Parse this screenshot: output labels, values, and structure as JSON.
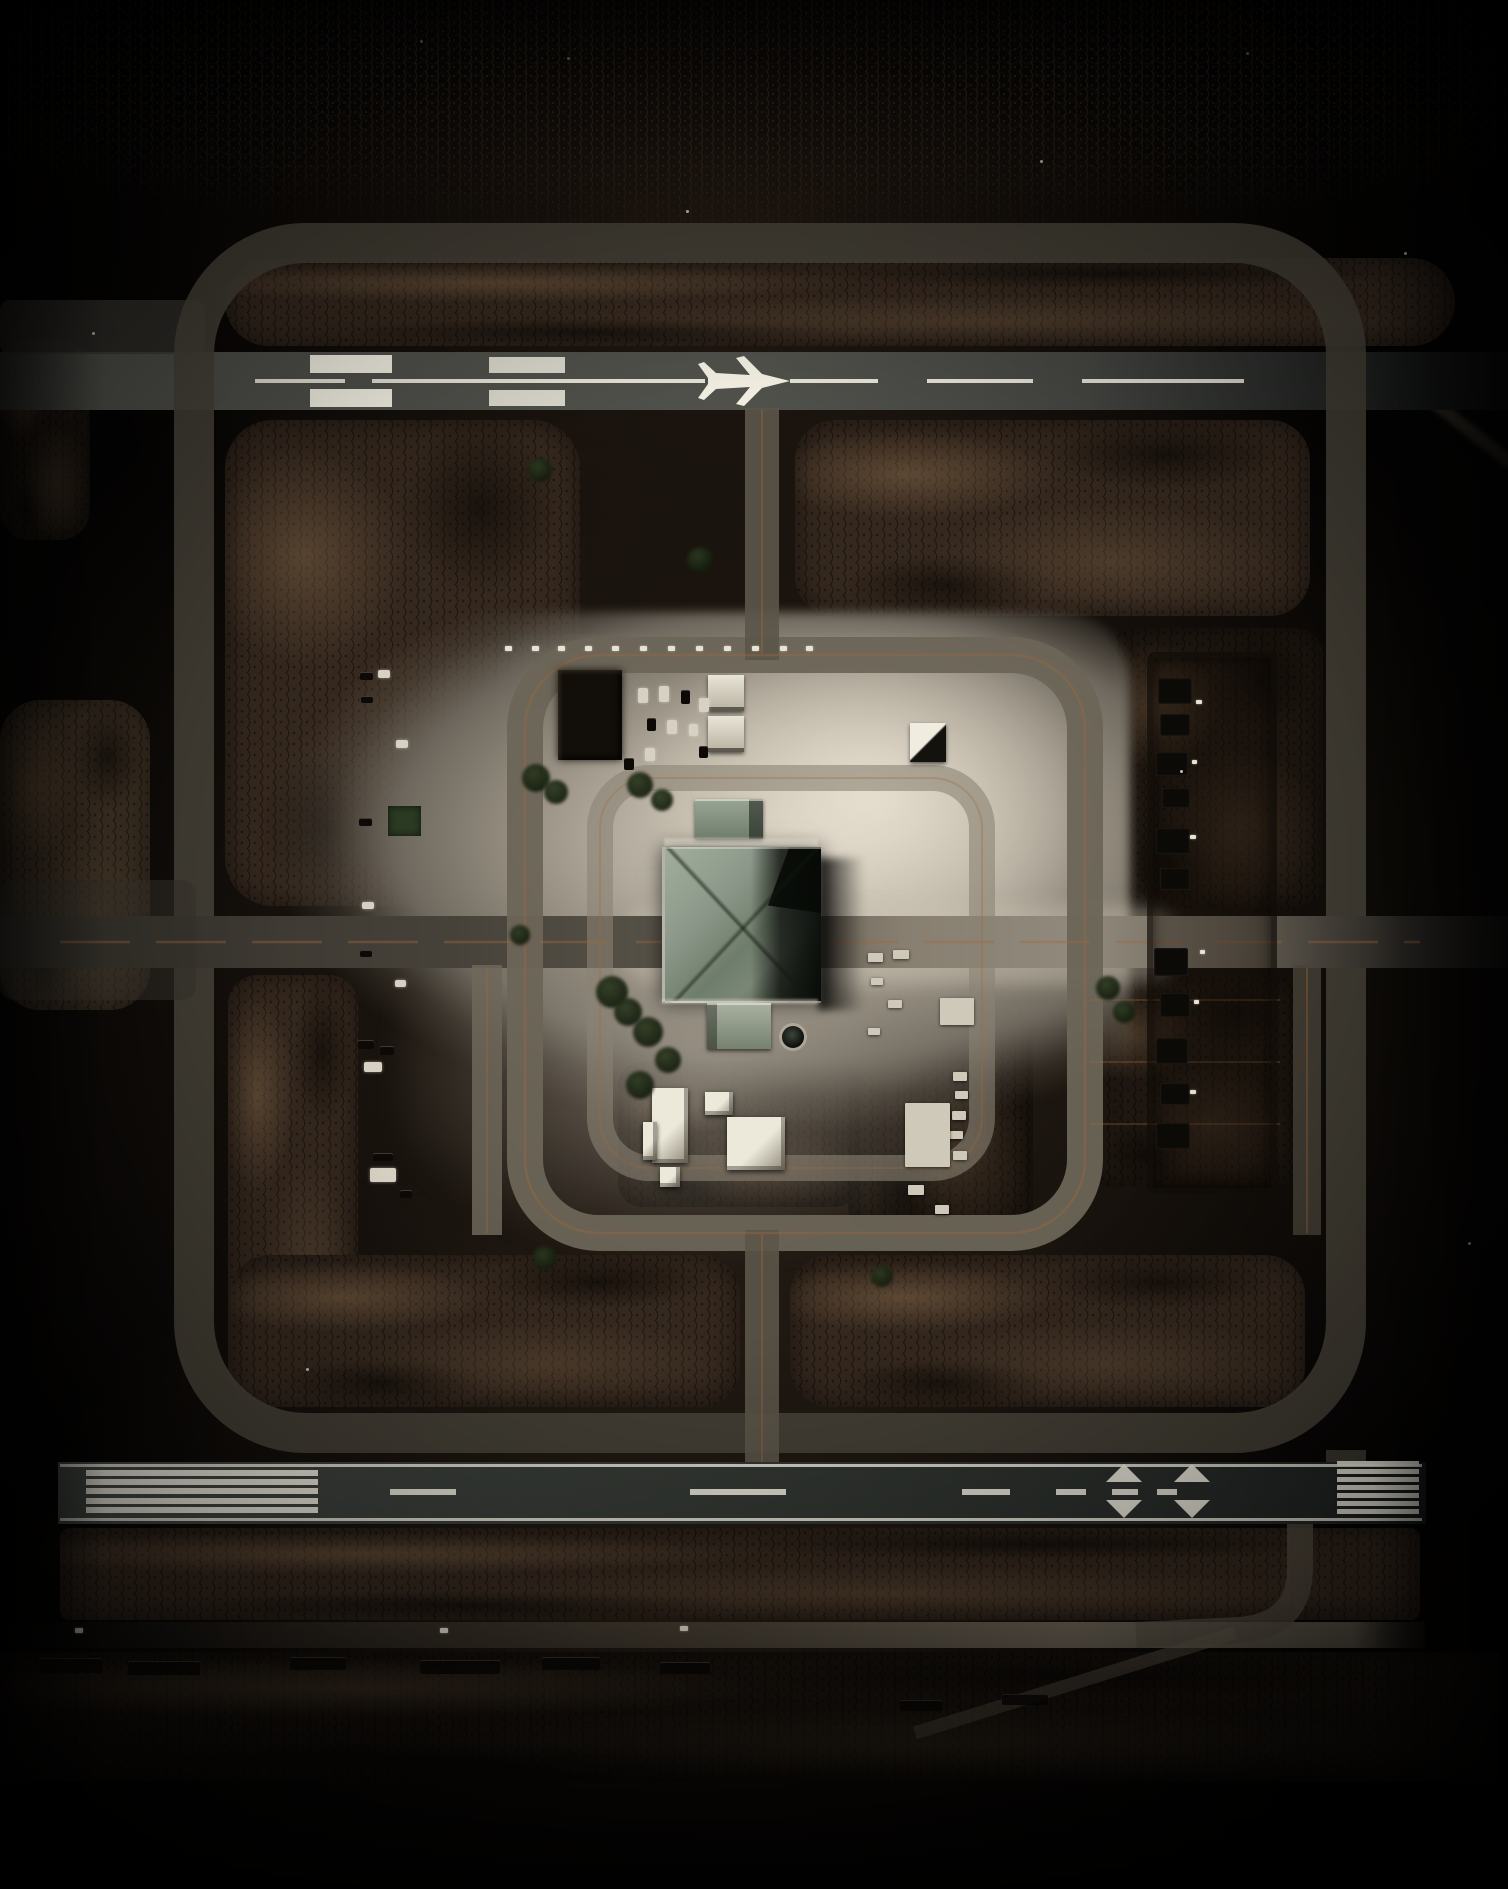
{
  "image": {
    "kind": "aerial-satellite-photograph",
    "description": "Night-time top-down aerial view of a square airfield compound: upper runway with airplane pavement marking, lower runway with threshold piano keys and triangle markings, rectangular taxiway loops, bright central apron and a large hip-roofed central building surrounded by lots, vehicles and dark desert terrain.",
    "width_px": 1508,
    "height_px": 1889
  },
  "palette": {
    "bg": "#040302",
    "terrain-dark": "#1d1510",
    "terrain-mid": "#35281e",
    "terrain-light": "#64503a",
    "road-gray": "#45413a",
    "runway-gray": "#4a4b46",
    "runway-dark": "#2a2d2b",
    "apron-bright": "#d9d2c2",
    "apron-mid": "#8f887b",
    "marking-white": "#f2efe2",
    "taxi-orange": "#9c6a3e",
    "roof-sage": "#8c9889",
    "tree-green": "#202a18",
    "vehicle-light": "#dcd7c8",
    "vehicle-dark": "#0d0a07"
  },
  "features": [
    "top-runway",
    "bottom-runway",
    "outer-taxiway-loop",
    "inner-taxiway-loop",
    "building-ring-road",
    "central-building",
    "north-annex",
    "south-annex",
    "bright-apron",
    "northwest-parking-compound",
    "right-dark-compound",
    "service-road",
    "diagonal-road",
    "tree-cover",
    "parked-vehicles"
  ],
  "structures": {
    "central_building": {
      "x": 662,
      "y": 847,
      "w": 156,
      "h": 154
    },
    "north_annex": {
      "x": 695,
      "y": 799,
      "w": 68,
      "h": 40
    },
    "south_annex": {
      "x": 707,
      "y": 1003,
      "w": 64,
      "h": 46
    },
    "dome": {
      "cx": 793,
      "cy": 1037,
      "r": 11
    },
    "nw_dark_building": {
      "x": 558,
      "y": 670,
      "w": 64,
      "h": 90
    },
    "twin_buildings": [
      [
        708,
        675,
        36,
        36
      ],
      [
        708,
        716,
        36,
        36
      ]
    ],
    "small_white_building": {
      "x": 910,
      "y": 723,
      "w": 36,
      "h": 39
    },
    "green_patch": {
      "x": 388,
      "y": 806,
      "w": 33,
      "h": 30
    },
    "right_compound_frame": {
      "x": 1147,
      "y": 652,
      "w": 118,
      "h": 530
    }
  },
  "markings": {
    "top_runway": {
      "centerline_y": 381,
      "centerline_segments": [
        [
          255,
          90
        ],
        [
          372,
          333
        ],
        [
          790,
          88
        ],
        [
          927,
          106
        ],
        [
          1082,
          162
        ]
      ],
      "threshold_bars": [
        {
          "x": 310,
          "w": 82,
          "rows": [
            355,
            389
          ],
          "h": 18,
          "opacity": 1
        },
        {
          "x": 489,
          "w": 76,
          "rows": [
            357,
            390
          ],
          "h": 16,
          "opacity": 0.85
        }
      ],
      "airplane_symbol": {
        "present": true,
        "heading": "right",
        "center": [
          746,
          381
        ]
      }
    },
    "bottom_runway": {
      "edge_lines": {
        "x": 60,
        "w": 1362,
        "ys": [
          1464,
          1518
        ],
        "h": 3
      },
      "left_stripes": {
        "x": 86,
        "w": 232,
        "h": 6,
        "ys": [
          1470,
          1479,
          1488,
          1498,
          1507
        ]
      },
      "right_stripes": {
        "x": 1337,
        "w": 82,
        "h": 5,
        "ys": [
          1461,
          1469,
          1477,
          1485,
          1493,
          1501,
          1509
        ]
      },
      "center_dashes": {
        "y": 1489,
        "h": 6,
        "xw": [
          [
            390,
            66
          ],
          [
            690,
            96
          ],
          [
            962,
            48
          ],
          [
            1056,
            30
          ],
          [
            1112,
            26
          ],
          [
            1157,
            20
          ]
        ]
      },
      "triangle_pairs": {
        "xs": [
          1106,
          1174
        ],
        "w": 36,
        "up": {
          "base_y": 1482,
          "apex_y": 1464
        },
        "down": {
          "base_y": 1500,
          "apex_y": 1518
        }
      }
    }
  },
  "objects": {
    "vehicles_left_lot": [
      [
        360,
        672,
        13,
        8,
        "dark"
      ],
      [
        378,
        670,
        12,
        8,
        "light"
      ],
      [
        361,
        696,
        12,
        7,
        "dark"
      ],
      [
        396,
        740,
        12,
        8,
        "light"
      ],
      [
        359,
        818,
        13,
        8,
        "dark"
      ],
      [
        362,
        902,
        12,
        7,
        "light"
      ],
      [
        360,
        950,
        12,
        7,
        "dark"
      ],
      [
        395,
        980,
        11,
        7,
        "light"
      ],
      [
        358,
        1040,
        16,
        9,
        "dark"
      ],
      [
        380,
        1046,
        14,
        9,
        "dark"
      ],
      [
        364,
        1062,
        18,
        10,
        "light"
      ],
      [
        373,
        1153,
        20,
        8,
        "dark"
      ],
      [
        370,
        1168,
        26,
        14,
        "light"
      ],
      [
        400,
        1190,
        12,
        8,
        "dark"
      ]
    ],
    "vehicles_center_lot": [
      [
        638,
        688,
        10,
        15,
        "light"
      ],
      [
        659,
        686,
        10,
        16,
        "light"
      ],
      [
        681,
        690,
        9,
        14,
        "dark"
      ],
      [
        699,
        698,
        10,
        14,
        "light"
      ],
      [
        647,
        718,
        9,
        13,
        "dark"
      ],
      [
        667,
        720,
        10,
        14,
        "light"
      ],
      [
        689,
        724,
        9,
        12,
        "light"
      ],
      [
        645,
        748,
        10,
        13,
        "light"
      ],
      [
        699,
        746,
        9,
        12,
        "dark"
      ],
      [
        624,
        758,
        10,
        12,
        "dark"
      ]
    ],
    "top_dots_row": {
      "y": 646,
      "w": 7,
      "h": 5,
      "xs": [
        505,
        532,
        558,
        585,
        612,
        640,
        668,
        696,
        724,
        752,
        780,
        806
      ]
    },
    "vehicles_bottom_row": [
      [
        40,
        1658,
        62,
        15
      ],
      [
        128,
        1661,
        72,
        14
      ],
      [
        290,
        1657,
        56,
        13
      ],
      [
        420,
        1660,
        80,
        14
      ],
      [
        542,
        1657,
        58,
        13
      ],
      [
        660,
        1662,
        50,
        12
      ],
      [
        900,
        1700,
        42,
        11
      ],
      [
        1002,
        1694,
        46,
        11
      ]
    ],
    "service_road_dots": [
      [
        75,
        1628
      ],
      [
        440,
        1628
      ],
      [
        680,
        1626
      ]
    ],
    "white_structures_right_plot": [
      [
        868,
        953,
        15,
        9
      ],
      [
        893,
        950,
        16,
        9
      ],
      [
        871,
        978,
        12,
        7
      ],
      [
        888,
        1000,
        14,
        8
      ],
      [
        868,
        1028,
        12,
        7
      ],
      [
        940,
        998,
        34,
        27
      ],
      [
        953,
        1072,
        14,
        9
      ],
      [
        955,
        1091,
        13,
        8
      ],
      [
        952,
        1111,
        14,
        9
      ],
      [
        950,
        1131,
        13,
        8
      ],
      [
        953,
        1151,
        14,
        9
      ],
      [
        905,
        1103,
        45,
        64
      ],
      [
        908,
        1185,
        16,
        10
      ],
      [
        935,
        1205,
        14,
        9
      ]
    ],
    "right_compound_cells": [
      [
        1158,
        678,
        34,
        26
      ],
      [
        1160,
        714,
        30,
        22
      ],
      [
        1156,
        752,
        32,
        24
      ],
      [
        1162,
        788,
        28,
        20
      ],
      [
        1156,
        828,
        34,
        26
      ],
      [
        1160,
        868,
        30,
        22
      ],
      [
        1154,
        948,
        34,
        28
      ],
      [
        1160,
        993,
        30,
        24
      ],
      [
        1156,
        1038,
        32,
        26
      ],
      [
        1160,
        1083,
        30,
        22
      ],
      [
        1156,
        1123,
        34,
        26
      ]
    ],
    "right_compound_specks": [
      [
        1196,
        700,
        6,
        4
      ],
      [
        1192,
        760,
        5,
        4
      ],
      [
        1190,
        835,
        6,
        4
      ],
      [
        1194,
        1000,
        5,
        4
      ],
      [
        1190,
        1090,
        6,
        4
      ],
      [
        1200,
        950,
        5,
        4
      ]
    ],
    "south_cluster_buildings": [
      [
        652,
        1088,
        36,
        75
      ],
      [
        643,
        1122,
        14,
        38
      ],
      [
        705,
        1092,
        28,
        23
      ],
      [
        727,
        1117,
        58,
        53
      ],
      [
        660,
        1167,
        20,
        20
      ]
    ],
    "trees": [
      [
        536,
        778,
        14
      ],
      [
        556,
        792,
        12
      ],
      [
        640,
        785,
        13
      ],
      [
        662,
        800,
        11
      ],
      [
        612,
        992,
        16
      ],
      [
        628,
        1012,
        14
      ],
      [
        648,
        1032,
        15
      ],
      [
        668,
        1060,
        13
      ],
      [
        640,
        1085,
        14
      ],
      [
        520,
        935,
        10
      ],
      [
        1108,
        988,
        12
      ],
      [
        1124,
        1012,
        11
      ],
      [
        545,
        1258,
        12
      ],
      [
        882,
        1276,
        11
      ],
      [
        700,
        560,
        13
      ],
      [
        540,
        470,
        12
      ]
    ],
    "light_specks": [
      [
        567,
        57
      ],
      [
        420,
        40
      ],
      [
        1246,
        52
      ],
      [
        1404,
        252
      ],
      [
        92,
        332
      ],
      [
        1468,
        1242
      ],
      [
        686,
        210
      ],
      [
        1040,
        160
      ],
      [
        306,
        1368
      ],
      [
        1180,
        770
      ]
    ]
  }
}
